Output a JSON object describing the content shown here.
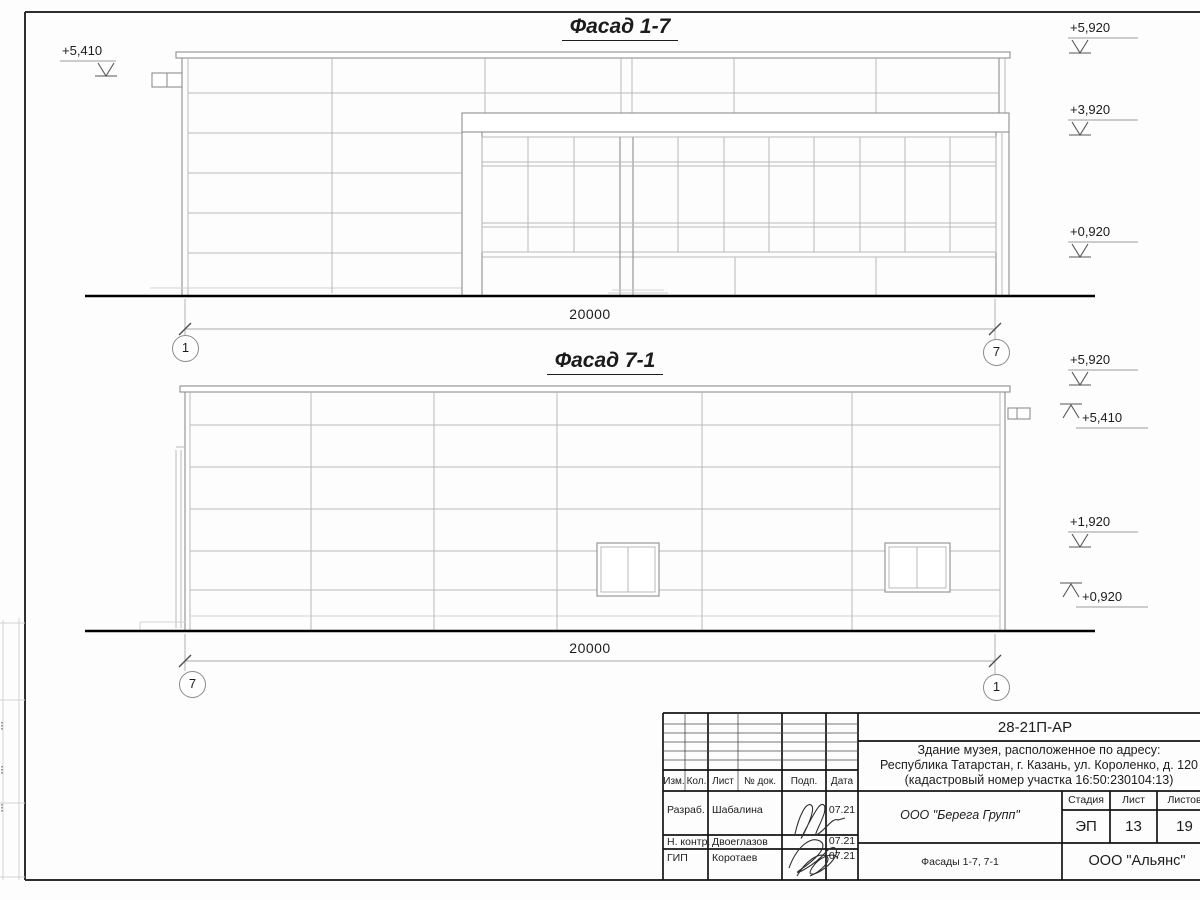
{
  "facade1": {
    "title": "Фасад 1-7",
    "dimension": "20000",
    "axis_left": "1",
    "axis_right": "7",
    "elev_left": "+5,410",
    "elev_r1": "+5,920",
    "elev_r2": "+3,920",
    "elev_r3": "+0,920"
  },
  "facade2": {
    "title": "Фасад 7-1",
    "dimension": "20000",
    "axis_left": "7",
    "axis_right": "1",
    "elev_r1": "+5,920",
    "elev_r2": "+5,410",
    "elev_r3": "+1,920",
    "elev_r4": "+0,920"
  },
  "titleblock": {
    "doc_code": "28-21П-АР",
    "object_line1": "Здание музея, расположенное по адресу:",
    "object_line2": "Республика Татарстан, г. Казань, ул. Короленко, д. 120",
    "object_line3": "(кадастровый номер участка 16:50:230104:13)",
    "col_izm": "Изм.",
    "col_kol": "Кол.",
    "col_list": "Лист",
    "col_doc": "№ док.",
    "col_sign": "Подп.",
    "col_date": "Дата",
    "row_developed_label": "Разраб.",
    "row_developed_name": "Шабалина",
    "row_developed_date": "07.21",
    "row_control_label": "Н. контр.",
    "row_control_name": "Двоеглазов",
    "row_control_date": "07.21",
    "row_gip_label": "ГИП",
    "row_gip_name": "Коротаев",
    "row_gip_date": "07.21",
    "designer": "ООО \"Берега Групп\"",
    "drawing_title": "Фасады 1-7, 7-1",
    "stage_label": "Стадия",
    "sheet_label": "Лист",
    "sheets_label": "Листов",
    "stage_value": "ЭП",
    "sheet_value": "13",
    "sheets_value": "19",
    "contractor": "ООО \"Альянс\""
  }
}
